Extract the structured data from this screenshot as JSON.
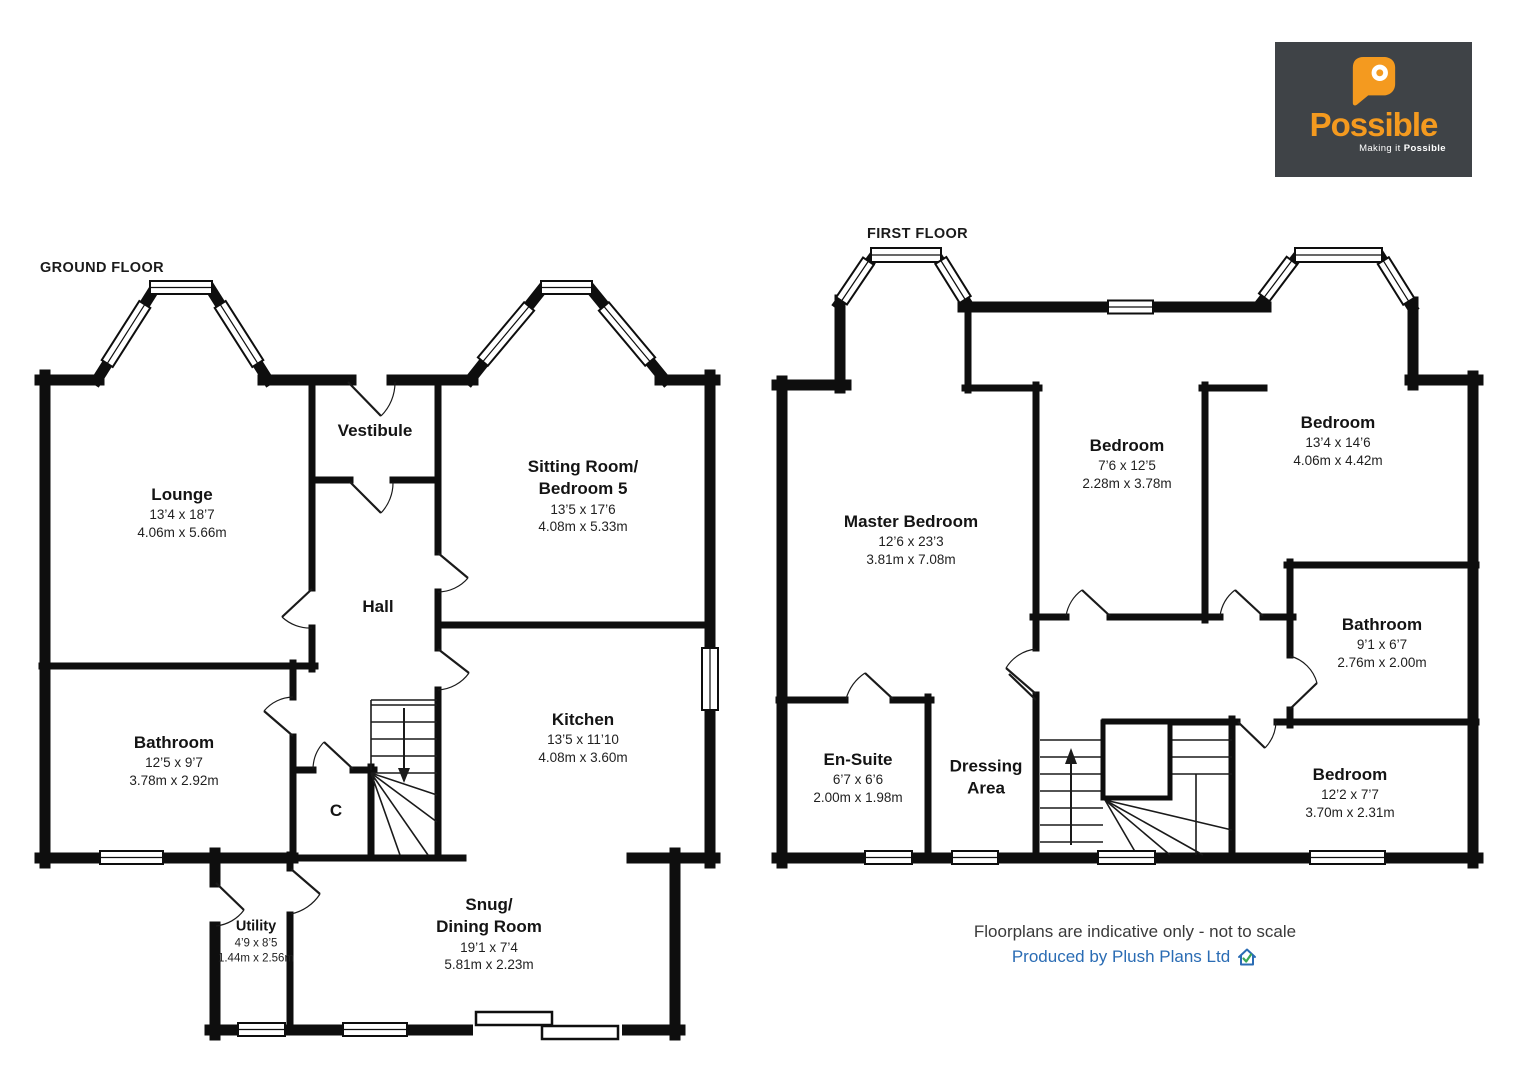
{
  "logo": {
    "brand": "Possible",
    "tagline_prefix": "Making it ",
    "tagline_bold": "Possible",
    "orange": "#f49a1f",
    "background": "#3f4347"
  },
  "floors": {
    "ground": {
      "label": "GROUND FLOOR",
      "rooms": {
        "lounge": {
          "name": "Lounge",
          "imperial": "13’4 x 18’7",
          "metric": "4.06m x 5.66m"
        },
        "vestibule": {
          "name": "Vestibule"
        },
        "sitting": {
          "name": "Sitting Room/",
          "name2": "Bedroom 5",
          "imperial": "13’5 x 17’6",
          "metric": "4.08m x 5.33m"
        },
        "hall": {
          "name": "Hall"
        },
        "bathroom": {
          "name": "Bathroom",
          "imperial": "12’5 x 9’7",
          "metric": "3.78m x 2.92m"
        },
        "closet": {
          "name": "C"
        },
        "kitchen": {
          "name": "Kitchen",
          "imperial": "13’5 x 11’10",
          "metric": "4.08m x 3.60m"
        },
        "utility": {
          "name": "Utility",
          "imperial": "4’9 x 8’5",
          "metric": "1.44m x 2.56m"
        },
        "snug": {
          "name": "Snug/",
          "name2": "Dining Room",
          "imperial": "19’1 x 7’4",
          "metric": "5.81m x 2.23m"
        }
      }
    },
    "first": {
      "label": "FIRST FLOOR",
      "rooms": {
        "master": {
          "name": "Master Bedroom",
          "imperial": "12’6 x 23’3",
          "metric": "3.81m x 7.08m"
        },
        "bedroom2": {
          "name": "Bedroom",
          "imperial": "7’6 x 12’5",
          "metric": "2.28m x 3.78m"
        },
        "bedroom3": {
          "name": "Bedroom",
          "imperial": "13’4 x 14’6",
          "metric": "4.06m x 4.42m"
        },
        "bathroom": {
          "name": "Bathroom",
          "imperial": "9’1 x 6’7",
          "metric": "2.76m x 2.00m"
        },
        "ensuite": {
          "name": "En-Suite",
          "imperial": "6’7 x 6’6",
          "metric": "2.00m x 1.98m"
        },
        "dressing": {
          "name": "Dressing",
          "name2": "Area"
        },
        "bedroom4": {
          "name": "Bedroom",
          "imperial": "12’2 x 7’7",
          "metric": "3.70m x 2.31m"
        }
      }
    }
  },
  "footer": {
    "disclaimer": "Floorplans are indicative only - not to scale",
    "credit": "Produced by Plush Plans Ltd",
    "link_color": "#2a6cb4",
    "check_color": "#3aa655"
  }
}
